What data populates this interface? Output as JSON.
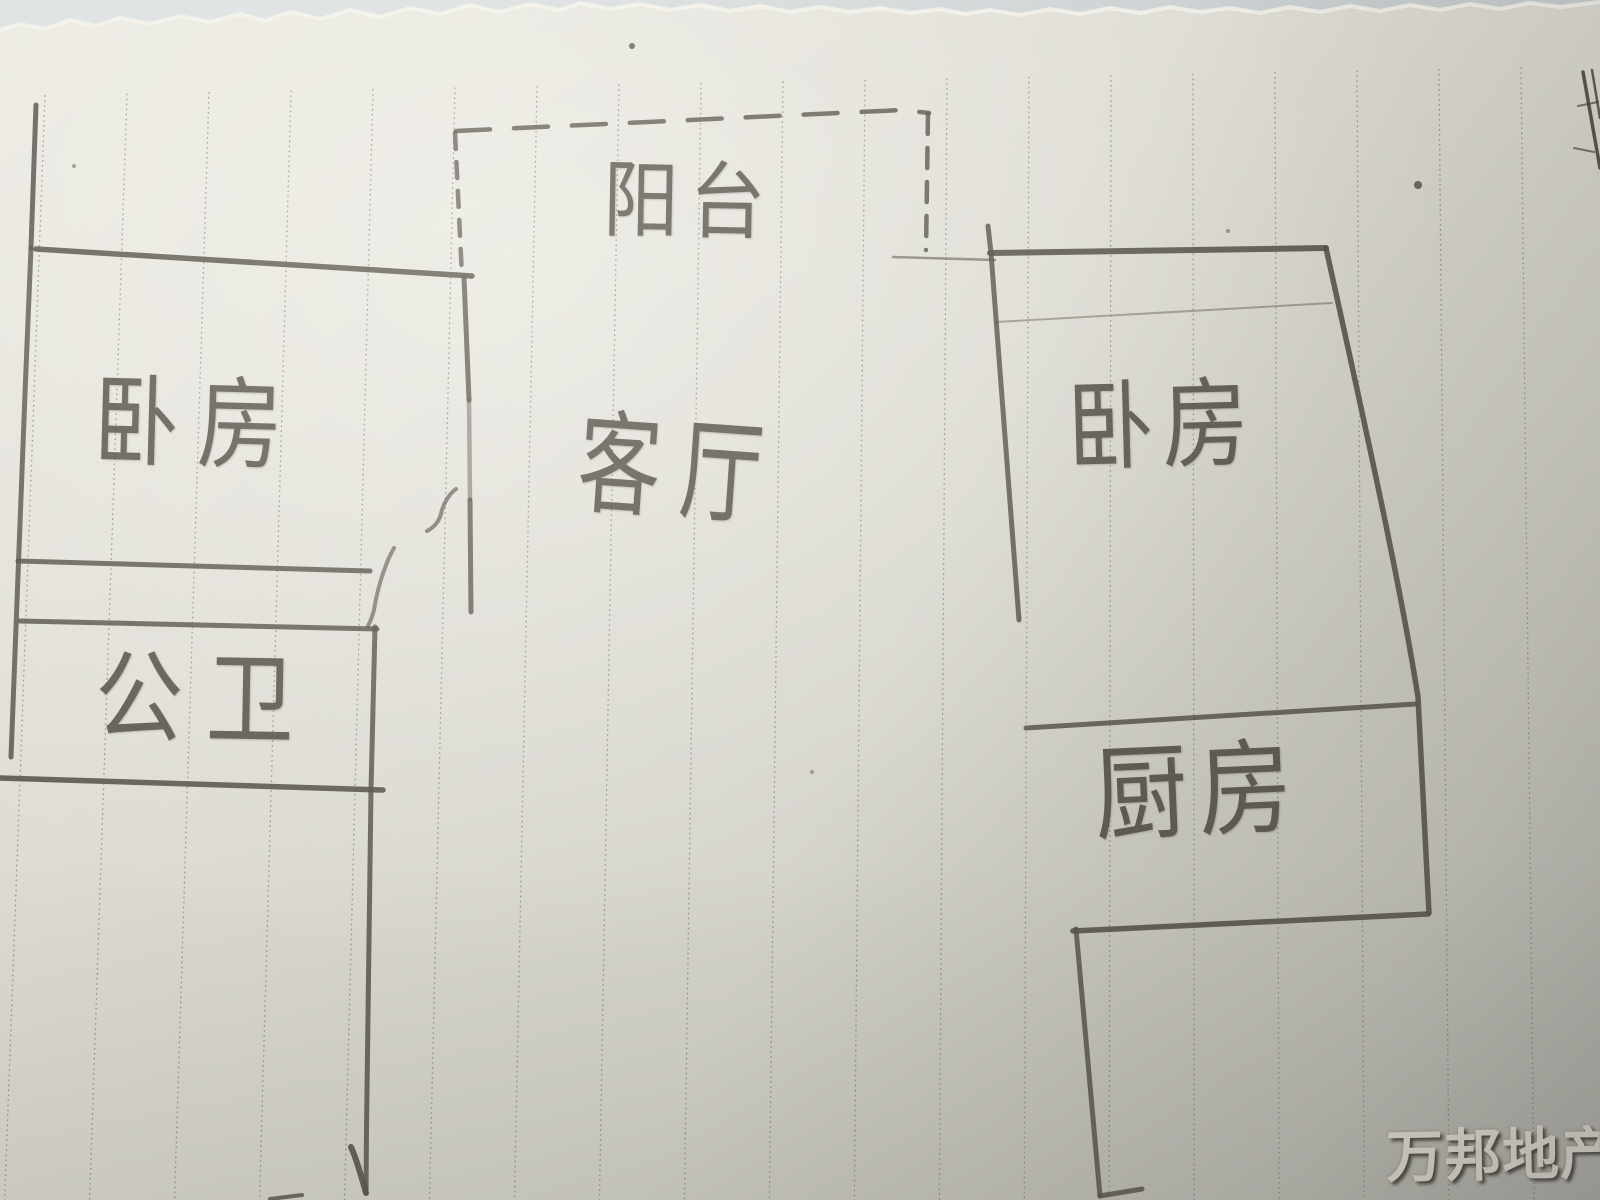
{
  "floor_plan": {
    "labels": {
      "balcony": "阳台",
      "bedroom_left": "卧房",
      "living_room": "客厅",
      "bedroom_right": "卧房",
      "bathroom": "公卫",
      "kitchen": "厨房"
    },
    "watermark": "万邦地产",
    "colors": {
      "pencil": "#57534b",
      "paper": "#dedcd4",
      "ruled_line": "#7e7e78",
      "watermark_text": "#ebe8e1"
    }
  }
}
